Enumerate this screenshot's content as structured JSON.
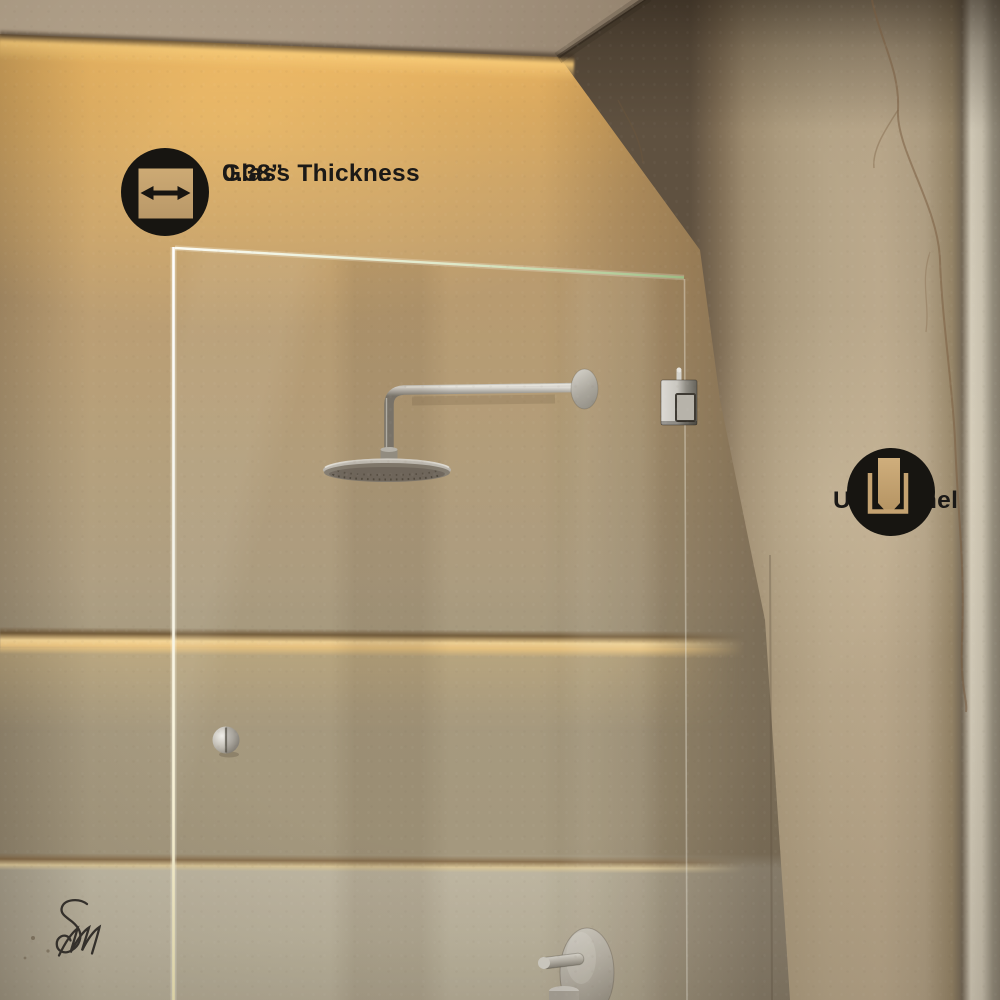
{
  "annotations": {
    "glass_thickness": {
      "label": "Glass Thickness",
      "value": "0.38”",
      "icon": "width-arrows-icon"
    },
    "u_channel": {
      "label": "U-Channel",
      "icon": "u-channel-icon"
    }
  },
  "brand": {
    "monogram": "SM"
  },
  "palette": {
    "callout_black": "#171511",
    "icon_beige": "#c7a674",
    "label_text": "#1b1917",
    "wall_gold": "#c99f60",
    "wall_tan": "#b3a284",
    "lower_wall": "#c1baa5",
    "metal_nickel": "#b9b6af",
    "monogram_ink": "#34302b"
  }
}
